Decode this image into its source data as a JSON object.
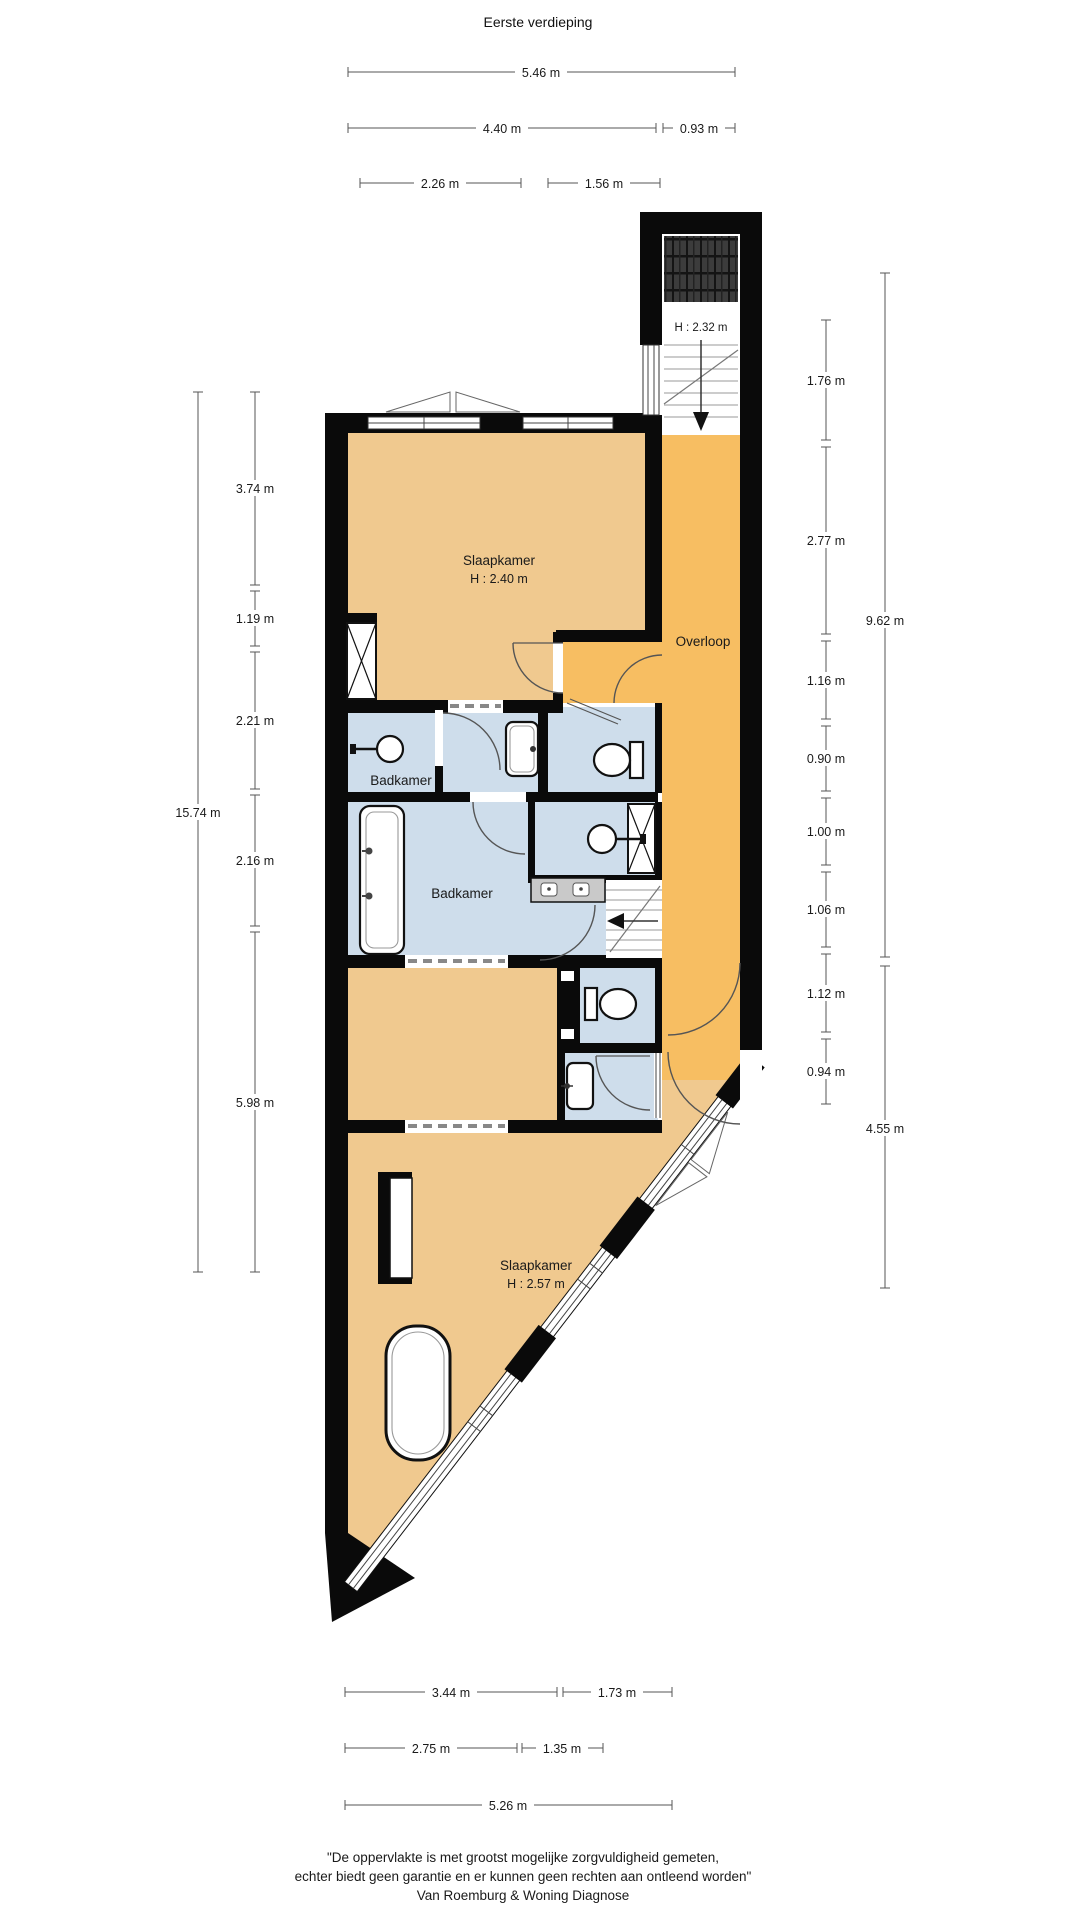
{
  "title": "Eerste verdieping",
  "floorplan": {
    "rooms": {
      "slaapkamer_top": {
        "label": "Slaapkamer",
        "height_label": "H : 2.40 m"
      },
      "slaapkamer_bottom": {
        "label": "Slaapkamer",
        "height_label": "H : 2.57 m"
      },
      "overloop": {
        "label": "Overloop"
      },
      "badkamer_small": {
        "label": "Badkamer"
      },
      "badkamer_large": {
        "label": "Badkamer"
      },
      "stairwell": {
        "height_label": "H : 2.32 m"
      }
    },
    "colors": {
      "room_fill": "#F0C98F",
      "hall_fill": "#F7BE62",
      "bath_fill": "#CEDDEB",
      "wall": "#0A0A0A"
    }
  },
  "dimensions": {
    "top": [
      "5.46 m",
      "4.40 m",
      "0.93 m",
      "2.26 m",
      "1.56 m"
    ],
    "left": [
      "3.74 m",
      "1.19 m",
      "2.21 m",
      "2.16 m",
      "5.98 m",
      "15.74 m"
    ],
    "right": [
      "1.76 m",
      "2.77 m",
      "1.16 m",
      "0.90 m",
      "1.00 m",
      "1.06 m",
      "1.12 m",
      "0.94 m",
      "9.62 m",
      "4.55 m"
    ],
    "bottom": [
      "3.44 m",
      "1.73 m",
      "2.75 m",
      "1.35 m",
      "5.26 m"
    ]
  },
  "footer": {
    "line1": "\"De oppervlakte is met grootst mogelijke zorgvuldigheid gemeten,",
    "line2": "echter biedt geen garantie en er kunnen geen rechten aan ontleend worden\"",
    "line3": "Van Roemburg & Woning Diagnose"
  }
}
